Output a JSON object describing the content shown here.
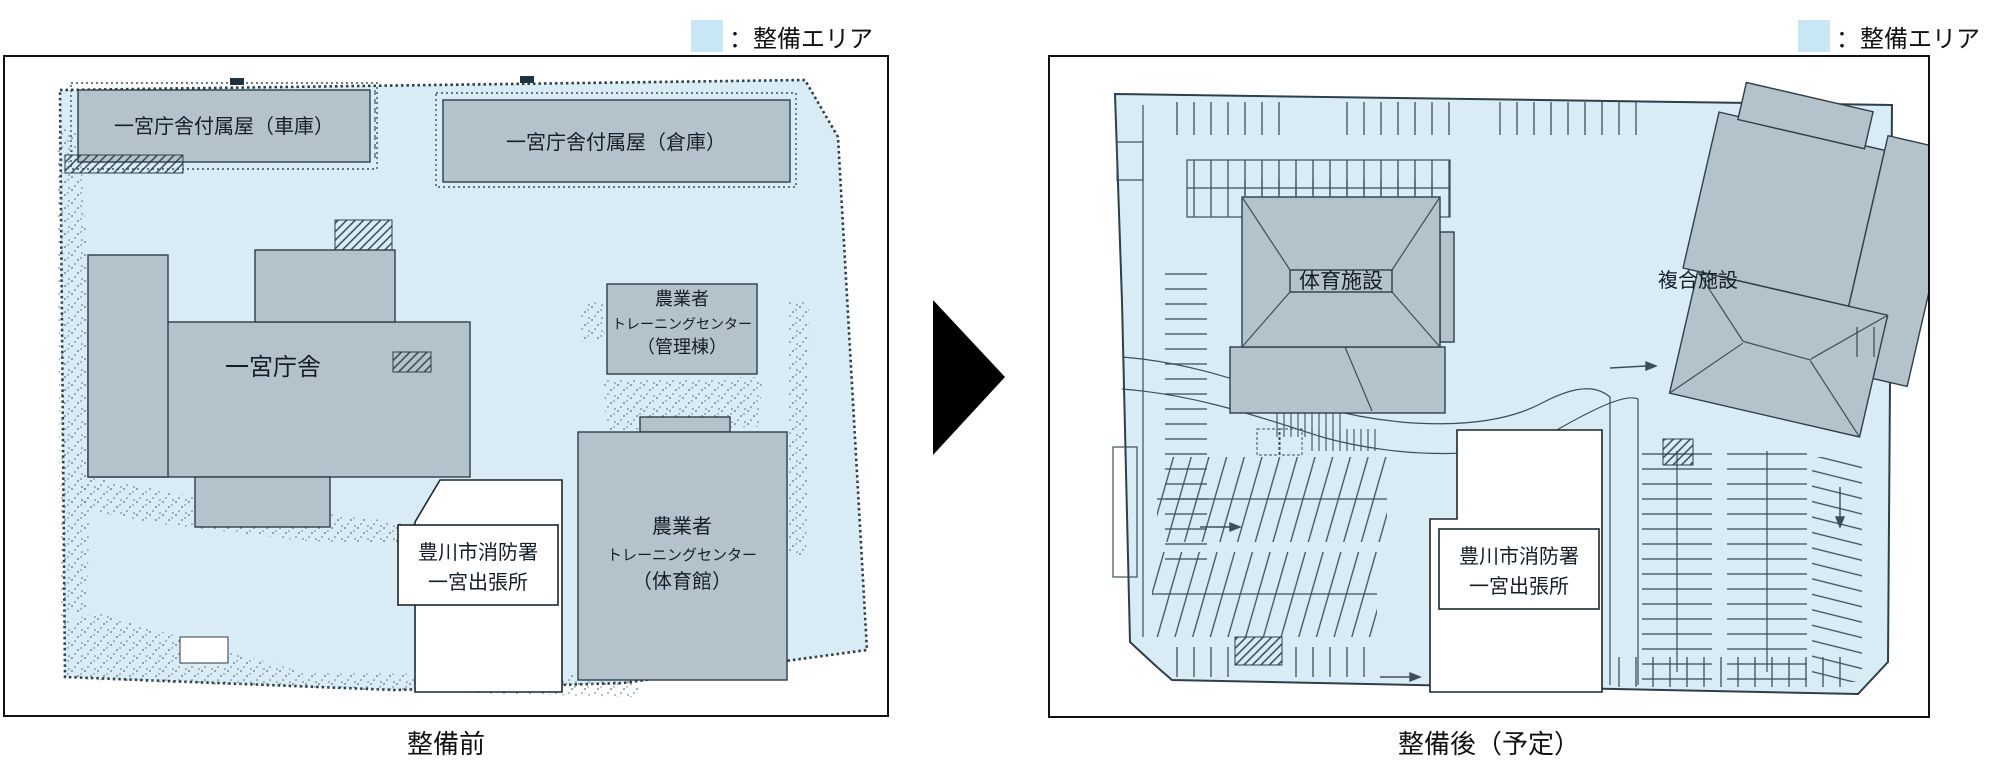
{
  "legend": {
    "label": "：整備エリア"
  },
  "colors": {
    "area": "#d9ecf6",
    "building": "#b4c3cb",
    "outline": "#2f3f49",
    "line": "#3d4e59",
    "swatch": "#c9e6f5"
  },
  "left_panel": {
    "caption": "整備前",
    "buildings": {
      "garage": {
        "label": "一宮庁舎付属屋（車庫）"
      },
      "warehouse": {
        "label": "一宮庁舎付属屋（倉庫）"
      },
      "main": {
        "label": "一宮庁舎"
      },
      "admin": {
        "lines": [
          "農業者",
          "トレーニングセンター",
          "（管理棟）"
        ]
      },
      "gym": {
        "lines": [
          "農業者",
          "トレーニングセンター",
          "（体育館）"
        ]
      },
      "fire": {
        "lines": [
          "豊川市消防署",
          "一宮出張所"
        ]
      }
    }
  },
  "right_panel": {
    "caption": "整備後（予定）",
    "buildings": {
      "sports": {
        "label": "体育施設"
      },
      "complex": {
        "label": "複合施設"
      },
      "fire": {
        "lines": [
          "豊川市消防署",
          "一宮出張所"
        ]
      }
    }
  }
}
